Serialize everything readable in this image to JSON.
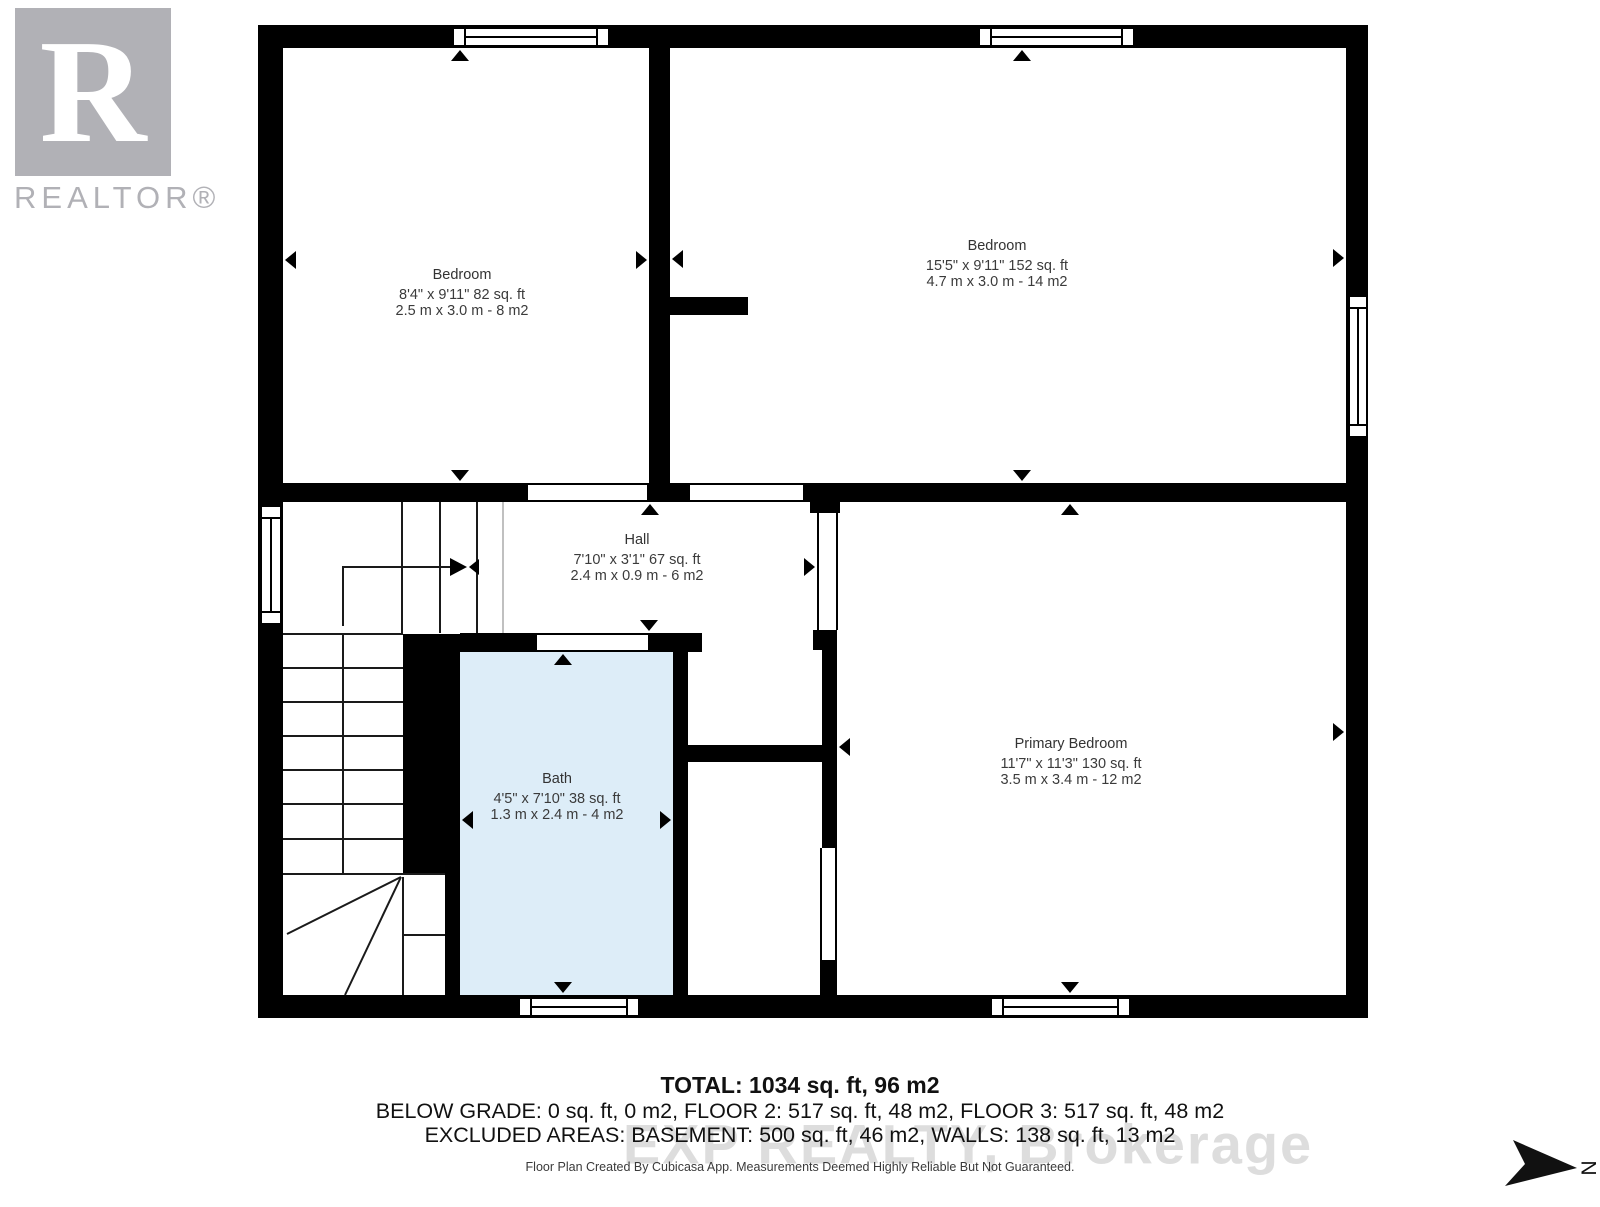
{
  "branding": {
    "logo_letter": "R",
    "logo_text": "REALTOR®"
  },
  "watermark": "EXP REALTY, Brokerage",
  "compass": {
    "label": "N"
  },
  "rooms": [
    {
      "name": "Bedroom",
      "dims_imperial": "8'4\" x 9'11\" 82 sq. ft",
      "dims_metric": "2.5 m x 3.0 m - 8 m2"
    },
    {
      "name": "Bedroom",
      "dims_imperial": "15'5\" x 9'11\" 152 sq. ft",
      "dims_metric": "4.7 m x 3.0 m - 14 m2"
    },
    {
      "name": "Hall",
      "dims_imperial": "7'10\" x 3'1\" 67 sq. ft",
      "dims_metric": "2.4 m x 0.9 m - 6 m2"
    },
    {
      "name": "Bath",
      "dims_imperial": "4'5\" x 7'10\" 38 sq. ft",
      "dims_metric": "1.3 m x 2.4 m - 4 m2"
    },
    {
      "name": "Primary Bedroom",
      "dims_imperial": "11'7\" x 11'3\" 130 sq. ft",
      "dims_metric": "3.5 m x 3.4 m - 12 m2"
    }
  ],
  "summary": {
    "total": "TOTAL: 1034 sq. ft, 96 m2",
    "floors": "BELOW GRADE: 0 sq. ft, 0 m2, FLOOR 2: 517 sq. ft, 48 m2, FLOOR 3: 517 sq. ft, 48 m2",
    "excluded": "EXCLUDED AREAS: BASEMENT: 500 sq. ft, 46 m2, WALLS: 138 sq. ft, 13 m2",
    "footnote": "Floor Plan Created By Cubicasa App. Measurements Deemed Highly Reliable But Not Guaranteed."
  },
  "colors": {
    "wall": "#000000",
    "bath_fill": "#ddedf8",
    "logo_gray": "#b1b1b6",
    "watermark_gray": "#d2d2d2"
  }
}
